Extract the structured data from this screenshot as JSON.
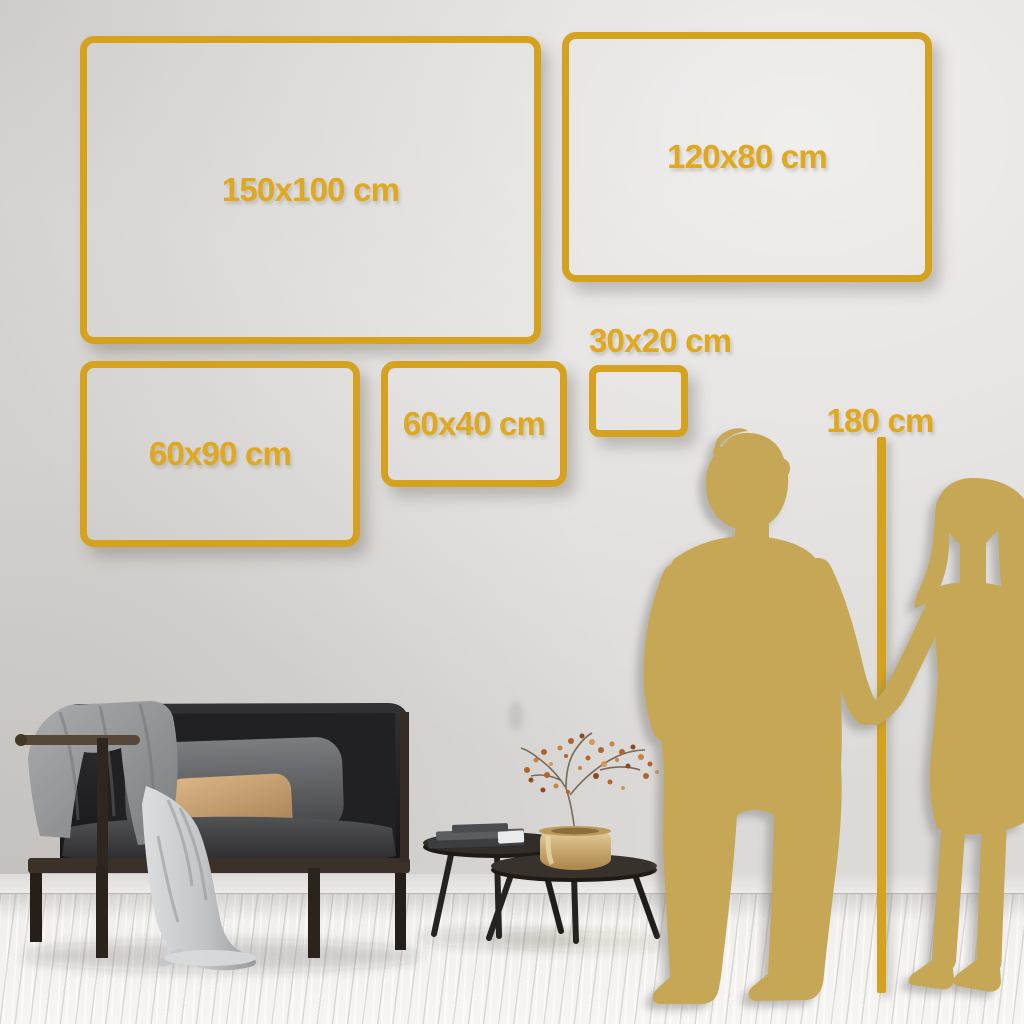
{
  "size_guide": {
    "unit": "cm",
    "frames": [
      {
        "width_cm": 150,
        "height_cm": 100,
        "label": "150x100 cm"
      },
      {
        "width_cm": 120,
        "height_cm": 80,
        "label": "120x80 cm"
      },
      {
        "width_cm": 60,
        "height_cm": 90,
        "label": "60x90 cm"
      },
      {
        "width_cm": 60,
        "height_cm": 40,
        "label": "60x40 cm"
      },
      {
        "width_cm": 30,
        "height_cm": 20,
        "label": "30x20 cm"
      }
    ],
    "height_reference": {
      "label": "180 cm",
      "value_cm": 180
    }
  },
  "colors": {
    "frame_gold": "#D5A21F",
    "label_gold": "#DFA81E",
    "silhouette_gold": "#C5A756",
    "wall_gray": "#DCDAD8",
    "floor_white": "#F3F2F0",
    "sofa_charcoal": "#232325",
    "pillow_tan": "#D0A873",
    "wood_dark": "#322A22",
    "vase_gold": "#C9A765",
    "berry_rust": "#B4622E"
  }
}
